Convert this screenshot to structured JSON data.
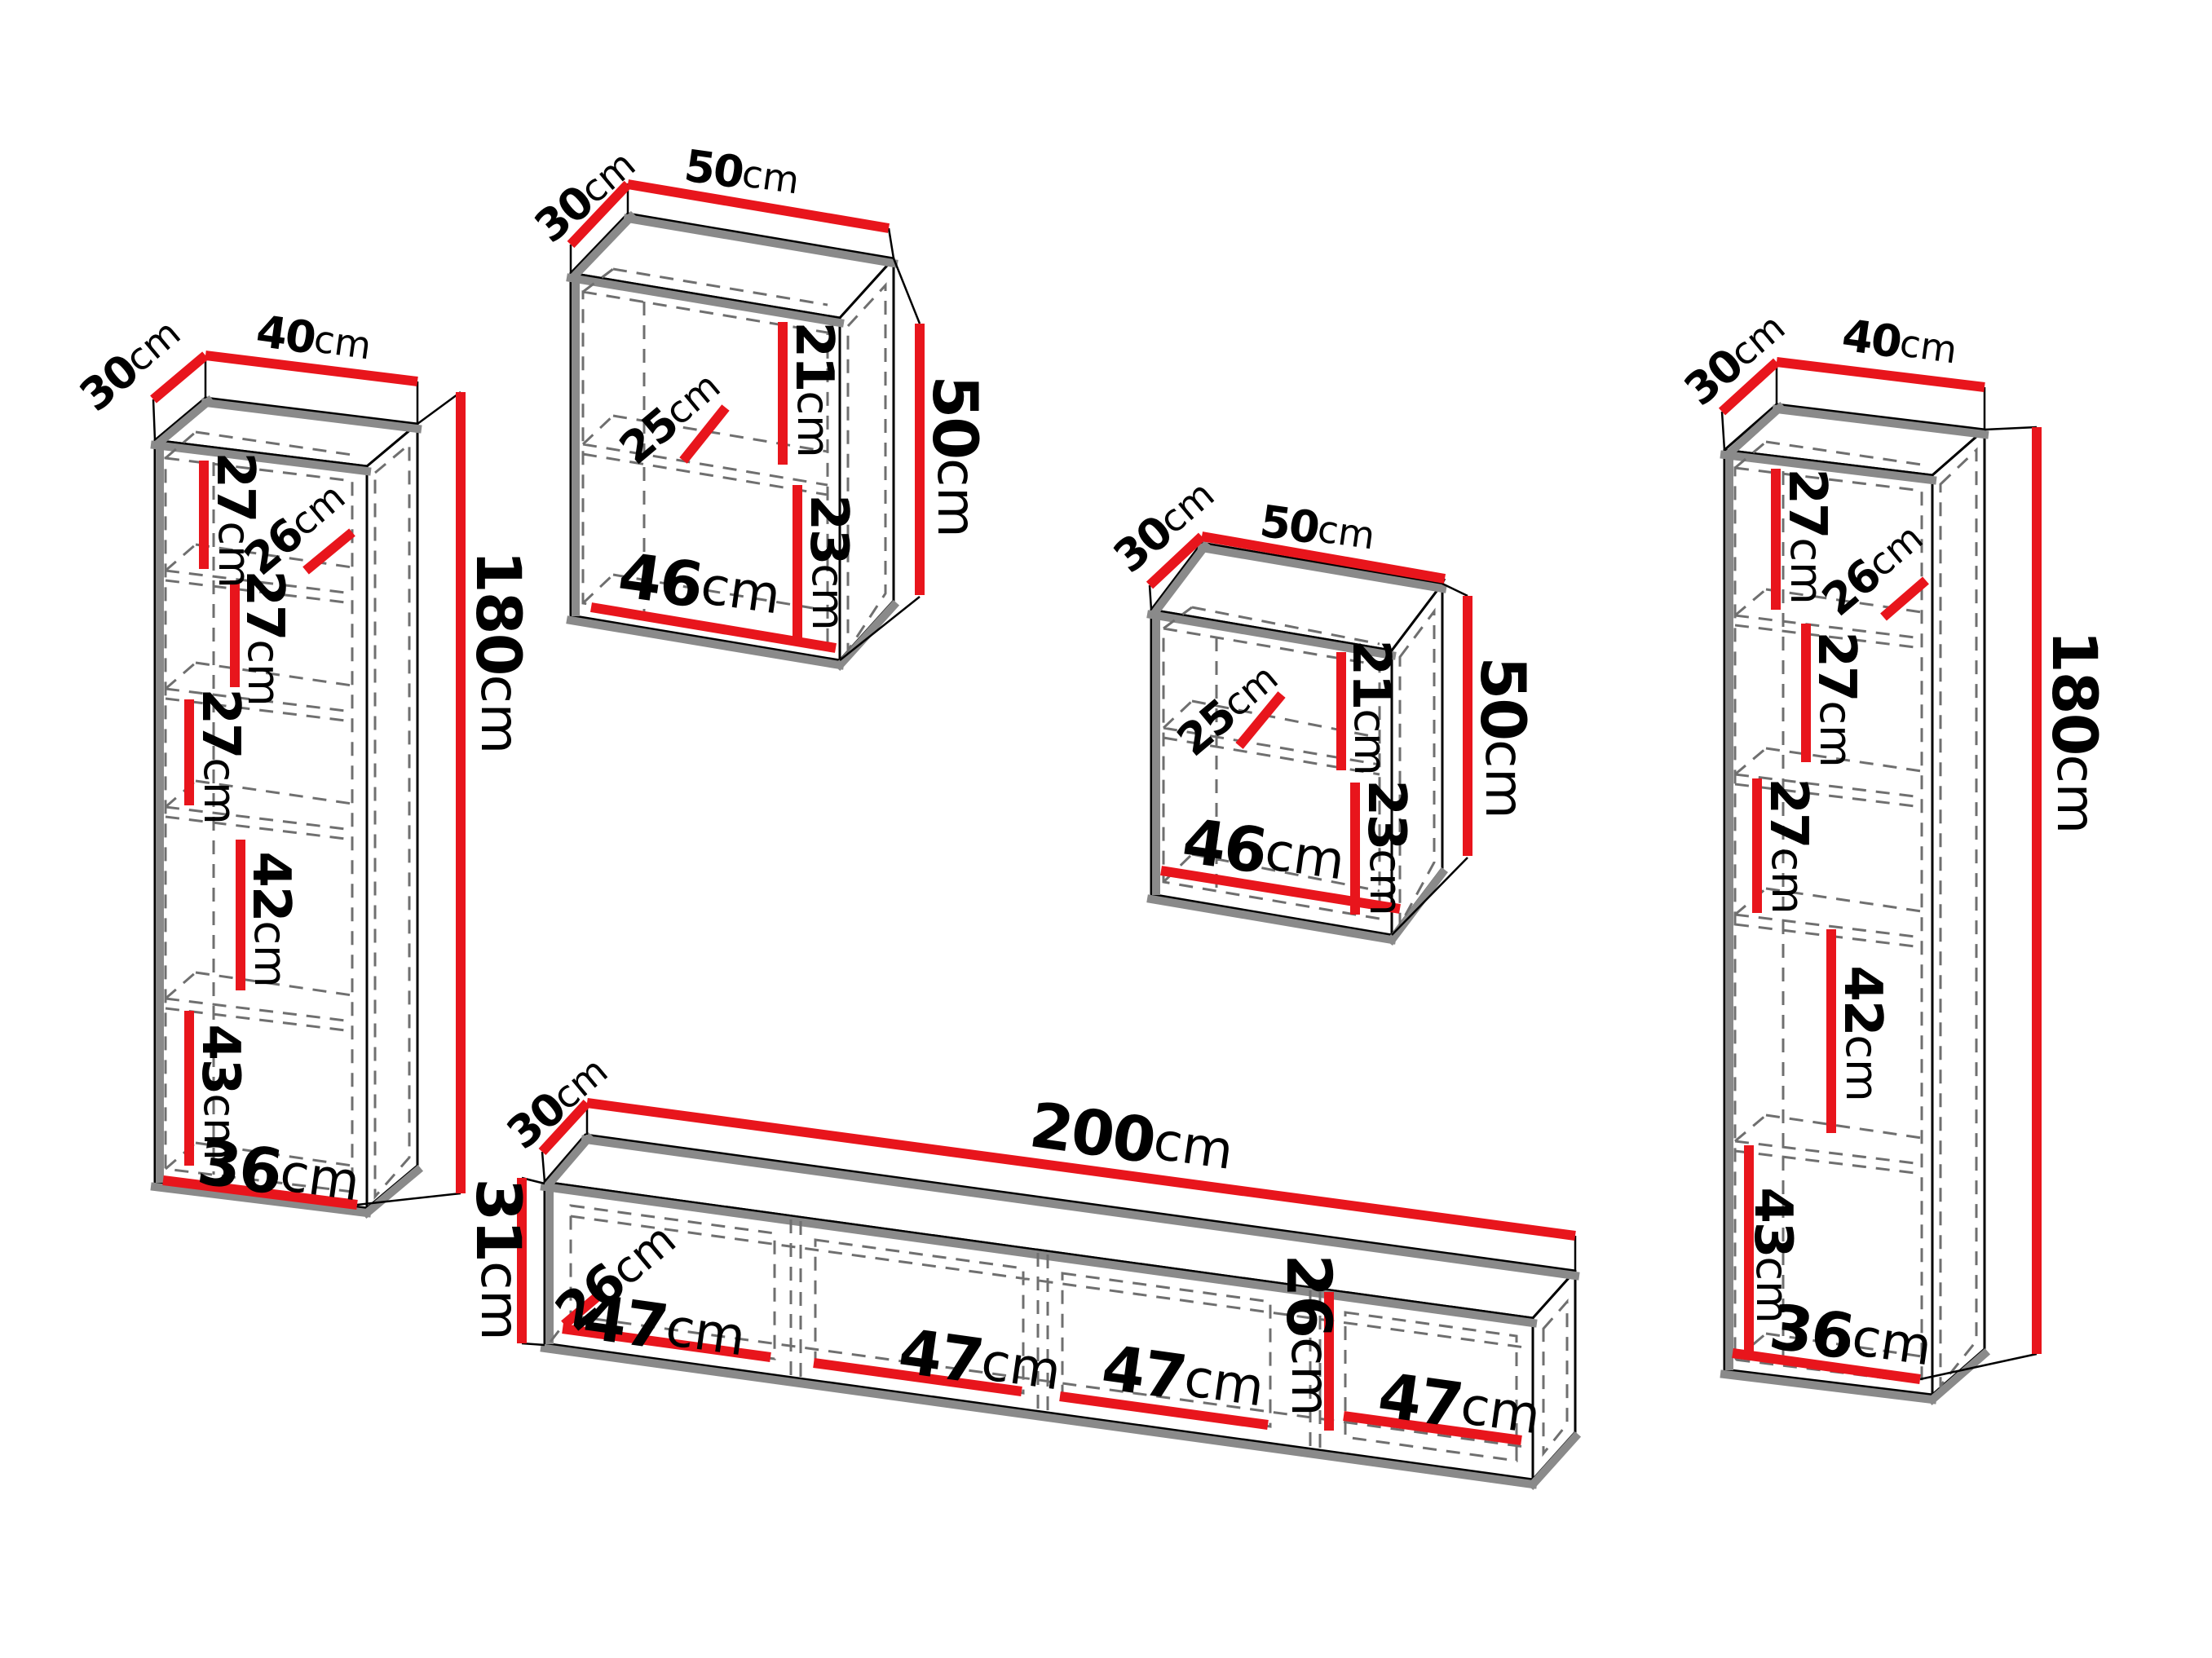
{
  "diagram": {
    "type": "furniture-dimension-diagram",
    "unit": "cm",
    "colors": {
      "dimension_line": "#e8151c",
      "outline": "#000000",
      "shading": "#8a8a8a",
      "hidden_line": "#6f6f6f",
      "background": "#ffffff"
    },
    "pieces": {
      "left_cabinet": {
        "name": "left tall cabinet",
        "depth": {
          "value": "30",
          "unit": "cm"
        },
        "width": {
          "value": "40",
          "unit": "cm"
        },
        "height": {
          "value": "180",
          "unit": "cm"
        },
        "interior": {
          "section1": {
            "value": "27",
            "unit": "cm"
          },
          "inner_width_top": {
            "value": "26",
            "unit": "cm"
          },
          "section2": {
            "value": "27",
            "unit": "cm"
          },
          "section3": {
            "value": "27",
            "unit": "cm"
          },
          "section4": {
            "value": "42",
            "unit": "cm"
          },
          "section5": {
            "value": "43",
            "unit": "cm"
          },
          "inner_width_bottom": {
            "value": "36",
            "unit": "cm"
          }
        }
      },
      "wall_cabinet_left": {
        "name": "wall cabinet",
        "depth": {
          "value": "30",
          "unit": "cm"
        },
        "width": {
          "value": "50",
          "unit": "cm"
        },
        "height": {
          "value": "50",
          "unit": "cm"
        },
        "interior": {
          "shelf_depth": {
            "value": "25",
            "unit": "cm"
          },
          "upper_section": {
            "value": "21",
            "unit": "cm"
          },
          "lower_section": {
            "value": "23",
            "unit": "cm"
          },
          "inner_width": {
            "value": "46",
            "unit": "cm"
          }
        }
      },
      "wall_cabinet_right": {
        "name": "wall cabinet",
        "depth": {
          "value": "30",
          "unit": "cm"
        },
        "width": {
          "value": "50",
          "unit": "cm"
        },
        "height": {
          "value": "50",
          "unit": "cm"
        },
        "interior": {
          "shelf_depth": {
            "value": "25",
            "unit": "cm"
          },
          "upper_section": {
            "value": "21",
            "unit": "cm"
          },
          "lower_section": {
            "value": "23",
            "unit": "cm"
          },
          "inner_width": {
            "value": "46",
            "unit": "cm"
          }
        }
      },
      "right_cabinet": {
        "name": "right tall cabinet",
        "depth": {
          "value": "30",
          "unit": "cm"
        },
        "width": {
          "value": "40",
          "unit": "cm"
        },
        "height": {
          "value": "180",
          "unit": "cm"
        },
        "interior": {
          "section1": {
            "value": "27",
            "unit": "cm"
          },
          "inner_width_top": {
            "value": "26",
            "unit": "cm"
          },
          "section2": {
            "value": "27",
            "unit": "cm"
          },
          "section3": {
            "value": "27",
            "unit": "cm"
          },
          "section4": {
            "value": "42",
            "unit": "cm"
          },
          "section5": {
            "value": "43",
            "unit": "cm"
          },
          "inner_width_bottom": {
            "value": "36",
            "unit": "cm"
          }
        }
      },
      "tv_stand": {
        "name": "tv stand",
        "depth": {
          "value": "30",
          "unit": "cm"
        },
        "width": {
          "value": "200",
          "unit": "cm"
        },
        "height": {
          "value": "31",
          "unit": "cm"
        },
        "interior": {
          "inner_depth": {
            "value": "26",
            "unit": "cm"
          },
          "compartment_1": {
            "value": "47",
            "unit": "cm"
          },
          "compartment_2": {
            "value": "47",
            "unit": "cm"
          },
          "compartment_3": {
            "value": "47",
            "unit": "cm"
          },
          "divider_height": {
            "value": "26",
            "unit": "cm"
          },
          "compartment_4": {
            "value": "47",
            "unit": "cm"
          }
        }
      }
    }
  }
}
